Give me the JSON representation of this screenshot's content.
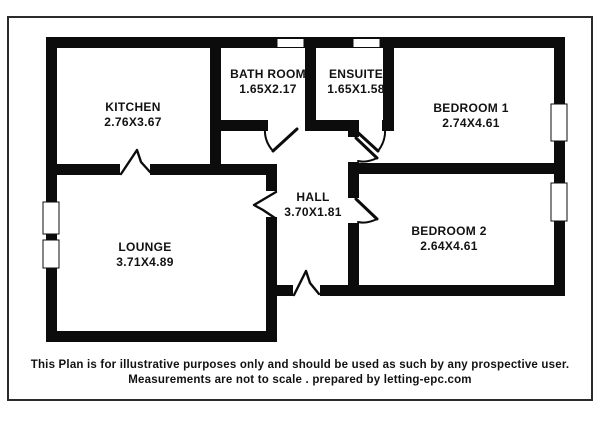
{
  "page": {
    "type": "floor-plan",
    "background_color": "#ffffff",
    "wall_color": "#0c0c0c",
    "border_color": "#2b2b2b"
  },
  "rooms": [
    {
      "id": "kitchen",
      "name": "KITCHEN",
      "dims": "2.76X3.67"
    },
    {
      "id": "bathroom",
      "name": "BATH ROOM",
      "dims": "1.65X2.17"
    },
    {
      "id": "ensuite",
      "name": "ENSUITE",
      "dims": "1.65X1.58"
    },
    {
      "id": "bedroom1",
      "name": "BEDROOM 1",
      "dims": "2.74X4.61"
    },
    {
      "id": "hall",
      "name": "HALL",
      "dims": "3.70X1.81"
    },
    {
      "id": "bedroom2",
      "name": "BEDROOM 2",
      "dims": "2.64X4.61"
    },
    {
      "id": "lounge",
      "name": "LOUNGE",
      "dims": "3.71X4.89"
    }
  ],
  "footer": {
    "line1": "This Plan is for illustrative purposes only and should be used as such by any prospective user.",
    "line2": "Measurements are not to scale . prepared by  letting-epc.com"
  }
}
